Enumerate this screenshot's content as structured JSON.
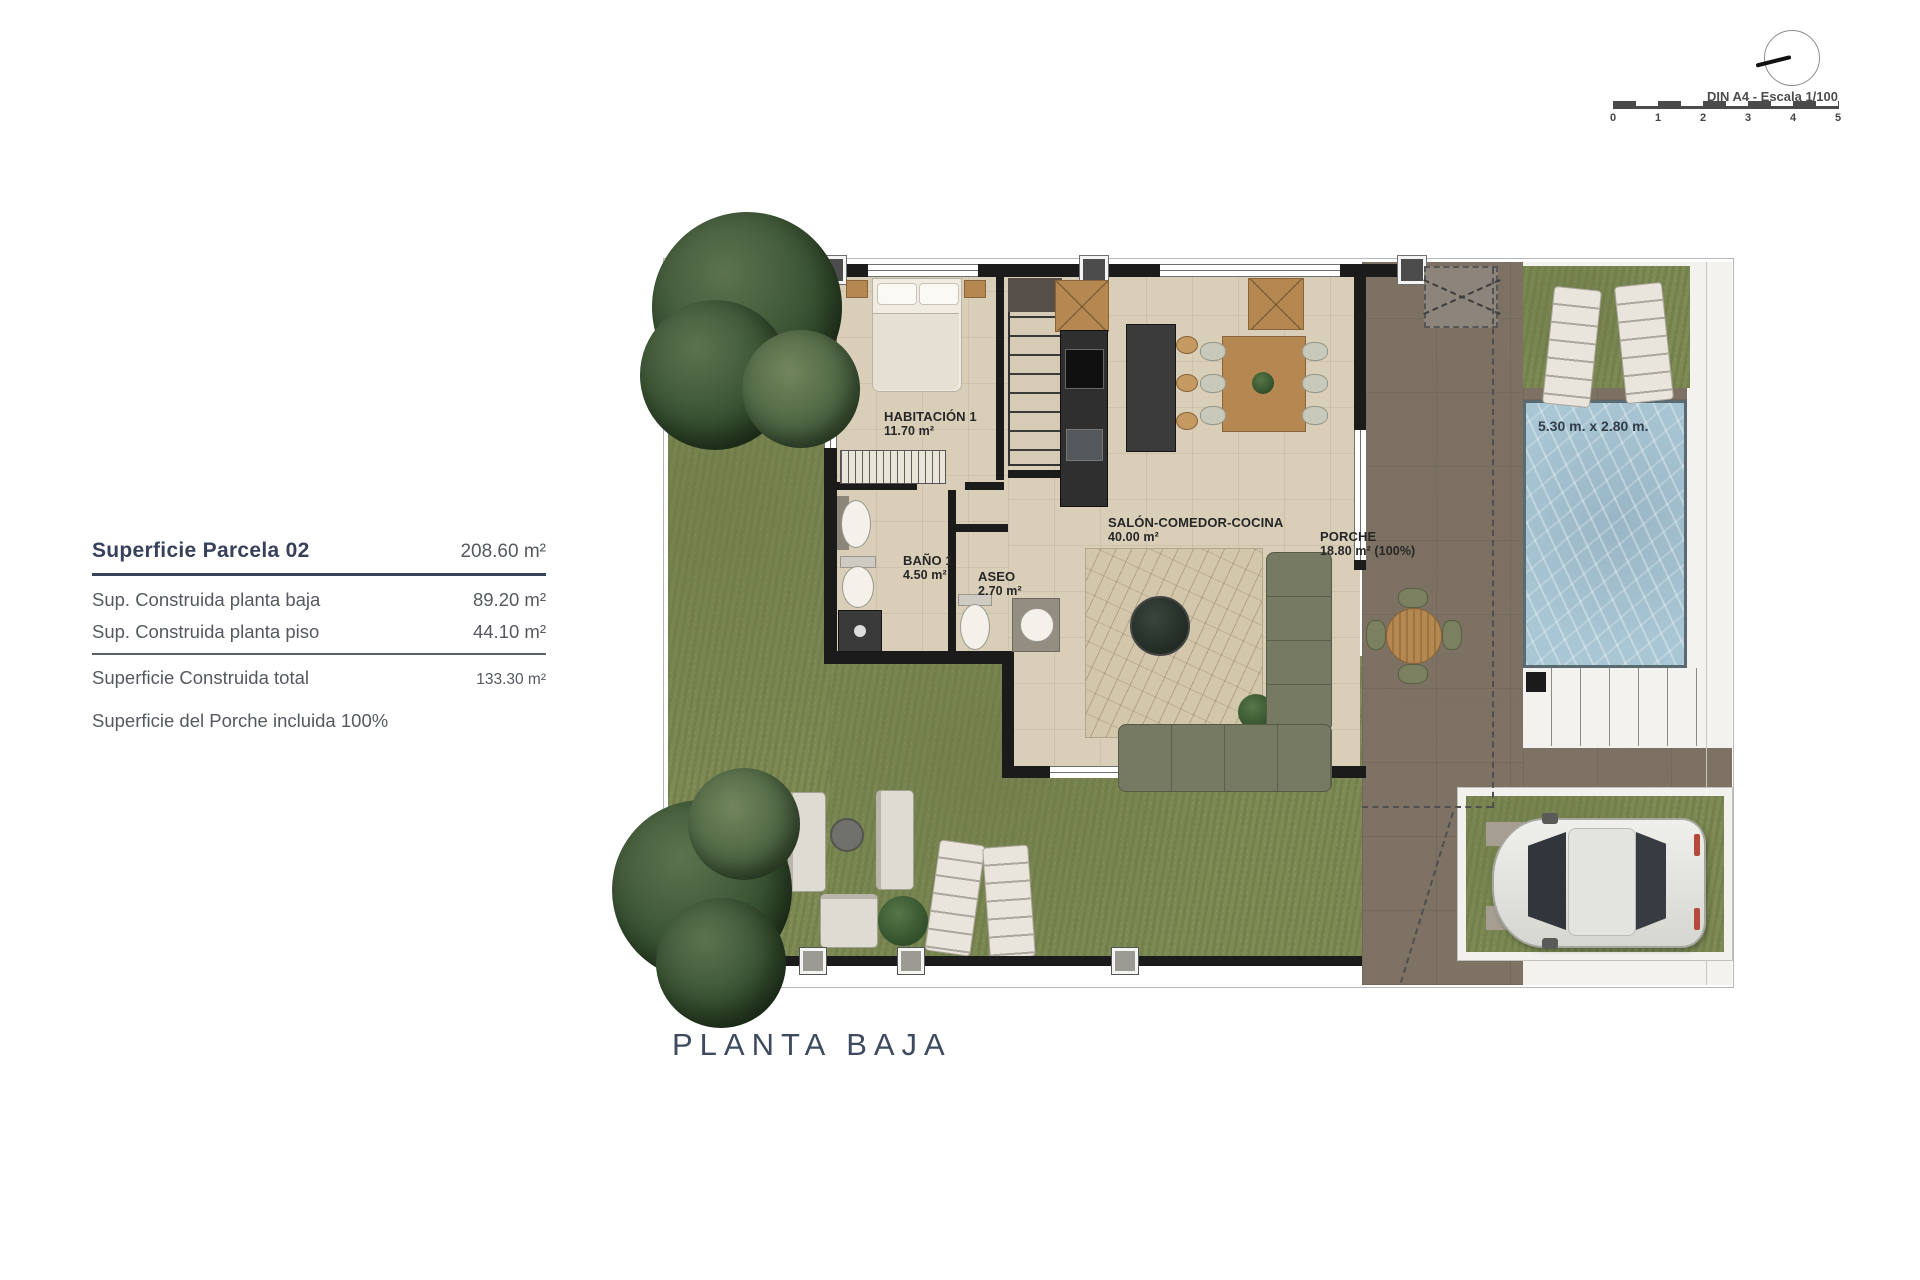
{
  "page": {
    "floor_title": "PLANTA BAJA"
  },
  "scale_indicator": {
    "label": "DIN A4 - Escala 1/100",
    "ticks": [
      "0",
      "1",
      "2",
      "3",
      "4",
      "5"
    ]
  },
  "summary_panel": {
    "title_label": "Superficie Parcela 02",
    "title_value": "208.60 m²",
    "rows": [
      {
        "label": "Sup. Construida planta baja",
        "value": "89.20 m²"
      },
      {
        "label": "Sup. Construida planta piso",
        "value": "44.10 m²"
      }
    ],
    "total_label": "Superficie Construida total",
    "total_value": "133.30 m²",
    "note": "Superficie del Porche incluida 100%"
  },
  "plan": {
    "rooms": [
      {
        "name": "HABITACIÓN 1",
        "area": "11.70 m²"
      },
      {
        "name": "BAÑO 1",
        "area": "4.50 m²"
      },
      {
        "name": "ASEO",
        "area": "2.70 m²"
      },
      {
        "name": "SALÓN-COMEDOR-COCINA",
        "area": "40.00 m²"
      },
      {
        "name": "PORCHE",
        "area": "18.80 m² (100%)"
      }
    ],
    "pool_dimensions": "5.30 m. x 2.80 m."
  },
  "colors": {
    "grass": "#7d8a54",
    "terrace": "#7e7264",
    "pool_water": "#a9c6d4",
    "interior_floor": "#d9cfb9",
    "wall": "#1b1b1b",
    "heading_text": "#37415a",
    "body_text": "#55595f"
  }
}
